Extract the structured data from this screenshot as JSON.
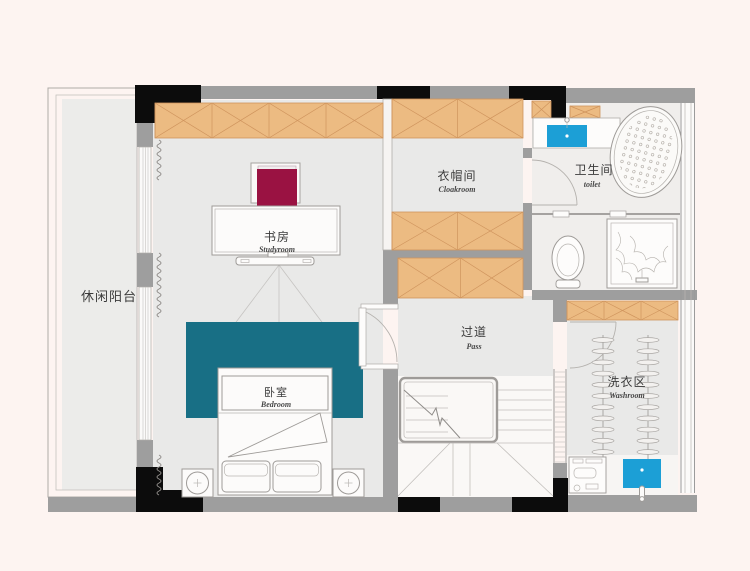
{
  "rooms": {
    "balcony": {
      "name_zh": "休闲阳台"
    },
    "studyroom": {
      "name_zh": "书房",
      "name_en": "Studyroom"
    },
    "cloakroom": {
      "name_zh": "衣帽间",
      "name_en": "Cloakroom"
    },
    "toilet": {
      "name_zh": "卫生间",
      "name_en": "toilet"
    },
    "pass": {
      "name_zh": "过道",
      "name_en": "Pass"
    },
    "bedroom": {
      "name_zh": "卧室",
      "name_en": "Bedroom"
    },
    "washroom": {
      "name_zh": "洗衣区",
      "name_en": "Washroom"
    }
  },
  "colors": {
    "background": "#fdf4f1",
    "floor": "#e9e9e8",
    "balcony_floor": "#ececea",
    "bathroom_floor": "#f0eeec",
    "stair_floor": "#faf8f6",
    "wall_gray": "#9e9e9e",
    "wall_black": "#0c0c0c",
    "wardrobe_fill": "#ecbb82",
    "wardrobe_line": "#cf945d",
    "rug_teal": "#186f85",
    "sink_blue": "#1c9fd6",
    "chair_red": "#9a1242"
  }
}
